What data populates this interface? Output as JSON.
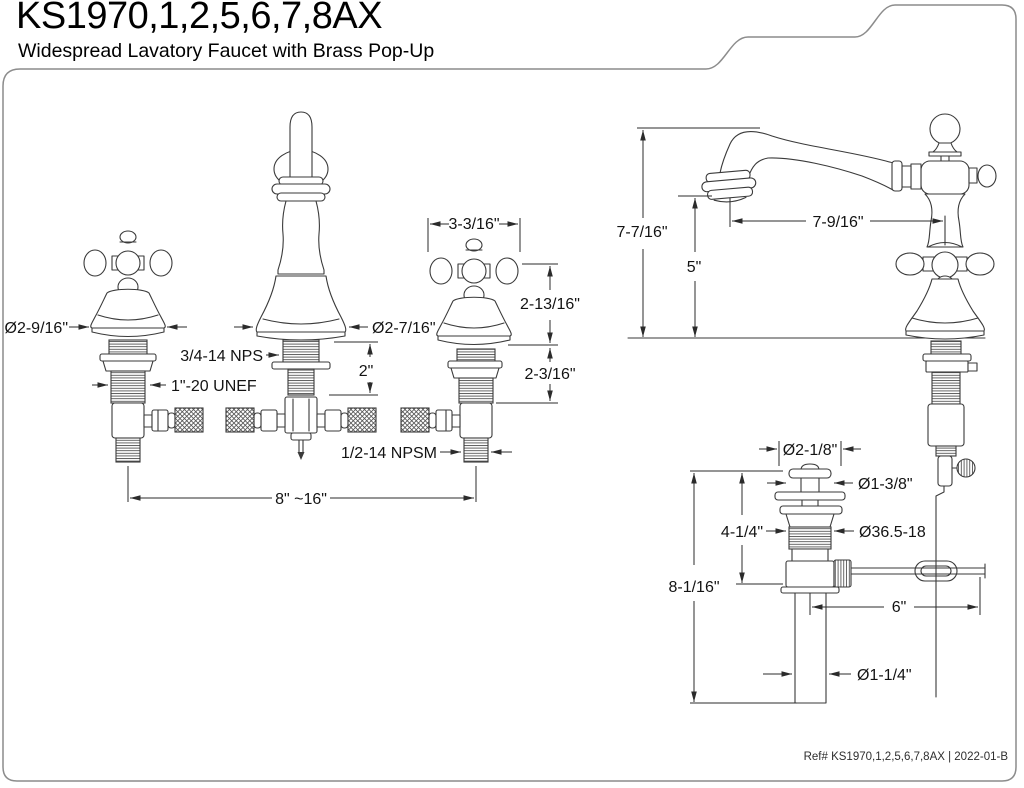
{
  "header": {
    "title": "KS1970,1,2,5,6,7,8AX",
    "subtitle": "Widespread Lavatory Faucet with Brass Pop-Up"
  },
  "footer": {
    "ref": "Ref# KS1970,1,2,5,6,7,8AX | 2022-01-B"
  },
  "colors": {
    "background": "#ffffff",
    "line_art": "#3a3a3a",
    "dimension": "#2b2b2b",
    "text": "#131313",
    "border": "#8c8c8c"
  },
  "front_view": {
    "dims": {
      "handle_diameter": "Ø2-9/16\"",
      "handle_width": "3-3/16\"",
      "spout_base_diameter": "Ø2-7/16\"",
      "spout_shank_thread": "3/4-14 NPS",
      "spout_shank_length": "2\"",
      "handle_shank_thread": "1\"-20 UNEF",
      "handle_height": "2-13/16\"",
      "handle_shank_length": "2-3/16\"",
      "supply_thread": "1/2-14 NPSM",
      "spread": "8\" ~16\""
    }
  },
  "side_view": {
    "dims": {
      "overall_height": "7-7/16\"",
      "spout_outlet_height": "5\"",
      "spout_reach": "7-9/16\""
    }
  },
  "drain_view": {
    "dims": {
      "flange_diameter": "Ø2-1/8\"",
      "stopper_diameter": "Ø1-3/8\"",
      "upper_length": "4-1/4\"",
      "body_thread": "Ø36.5-18",
      "overall_length": "8-1/16\"",
      "rod_length": "6\"",
      "tailpiece_diameter": "Ø1-1/4\""
    }
  }
}
